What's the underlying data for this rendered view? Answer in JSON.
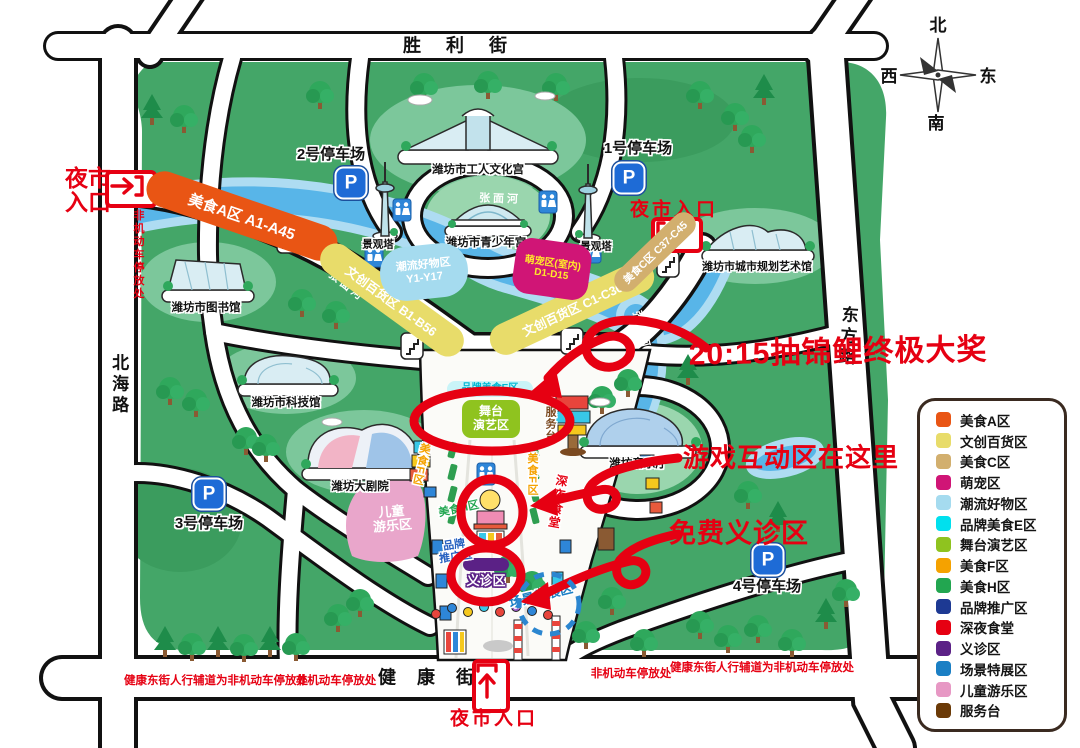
{
  "compass": {
    "north": "北",
    "south": "南",
    "east": "东",
    "west": "西"
  },
  "streets": {
    "top": "胜 利 街",
    "bottom": "健 康 街",
    "left": "北海路",
    "right": "东方路"
  },
  "street_notes": {
    "left_vertical": "非机动车停放处",
    "bottom_left_long": "健康东街人行辅道为非机动车停放处",
    "bottom_left_short": "非机动车停放处",
    "bottom_right_short": "非机动车停放处",
    "bottom_right_long": "健康东街人行辅道为非机动车停放处"
  },
  "entrances": {
    "left": "夜市入口",
    "right": "夜市入口",
    "bottom": "夜市入口"
  },
  "parking": {
    "icon_letter": "P",
    "p1": "1号停车场",
    "p2": "2号停车场",
    "p3": "3号停车场",
    "p4": "4号停车场"
  },
  "buildings": {
    "workers_culture_palace": "潍坊市工人文化宫",
    "youth_palace": "潍坊市青少年宫",
    "library": "潍坊市图书馆",
    "urban_planning_art_gallery": "潍坊市城市规划艺术馆",
    "science_museum": "潍坊市科技馆",
    "grand_theatre": "潍坊大剧院",
    "concert_hall": "潍坊音乐厅",
    "viewing_tower": "景观塔"
  },
  "river": {
    "name": "张面河"
  },
  "zones": {
    "food_a": {
      "label": "美食A区 A1-A45",
      "color": "#E95514"
    },
    "wenchuang_b": {
      "label": "文创百货区 B1-B56",
      "color": "#E8DC6A"
    },
    "wenchuang_c": {
      "label": "文创百货区 C1-C36",
      "color": "#E8DC6A"
    },
    "food_c": {
      "label": "美食C区 C37-C45",
      "color": "#D2AF6E"
    },
    "trendy": {
      "line1": "潮流好物区",
      "line2": "Y1-Y17",
      "color": "#A5DBEF"
    },
    "pets": {
      "line1": "萌宠区(室内)",
      "line2": "D1-D15",
      "color": "#D01576",
      "text_color": "#FFE92A"
    },
    "brand_food_e": {
      "label": "品牌美食E区",
      "color": "#00B8D4",
      "bg": "#C9F4F8"
    },
    "stage": {
      "line1": "舞台",
      "line2": "演艺区",
      "color": "#8FC31F"
    },
    "food_f": {
      "label": "美食F区",
      "color": "#F5A200"
    },
    "food_h": {
      "label": "美食H区",
      "color": "#22A650"
    },
    "late_night": {
      "label": "深夜食堂",
      "color": "#E60012"
    },
    "brand_promo": {
      "line1": "品牌",
      "line2": "推广区",
      "color": "#2560C0"
    },
    "clinic": {
      "label": "义诊区",
      "color": "#5B2186"
    },
    "scene_expo": {
      "label": "场景特展区",
      "color": "#1B7FC4"
    },
    "kids": {
      "line1": "儿童",
      "line2": "游乐区",
      "color": "#E9A6CB"
    },
    "service_desk": {
      "label": "服务台",
      "color": "#7B4A21"
    }
  },
  "annotations": {
    "grand_prize": "20:15抽锦鲤终极大奖",
    "game_zone": "游戏互动区在这里",
    "free_clinic": "免费义诊区",
    "color": "#E60012"
  },
  "legend": {
    "items": [
      {
        "label": "美食A区",
        "color": "#E95514"
      },
      {
        "label": "文创百货区",
        "color": "#E8DC6A"
      },
      {
        "label": "美食C区",
        "color": "#D2AF6E"
      },
      {
        "label": "萌宠区",
        "color": "#D01576"
      },
      {
        "label": "潮流好物区",
        "color": "#A5DBEF"
      },
      {
        "label": "品牌美食E区",
        "color": "#00E0EE"
      },
      {
        "label": "舞台演艺区",
        "color": "#8FC31F"
      },
      {
        "label": "美食F区",
        "color": "#F5A200"
      },
      {
        "label": "美食H区",
        "color": "#22A650"
      },
      {
        "label": "品牌推广区",
        "color": "#1D3993"
      },
      {
        "label": "深夜食堂",
        "color": "#E60012"
      },
      {
        "label": "义诊区",
        "color": "#5B2186"
      },
      {
        "label": "场景特展区",
        "color": "#1B7FC4"
      },
      {
        "label": "儿童游乐区",
        "color": "#E798C4"
      },
      {
        "label": "服务台",
        "color": "#6B3A07"
      }
    ]
  }
}
